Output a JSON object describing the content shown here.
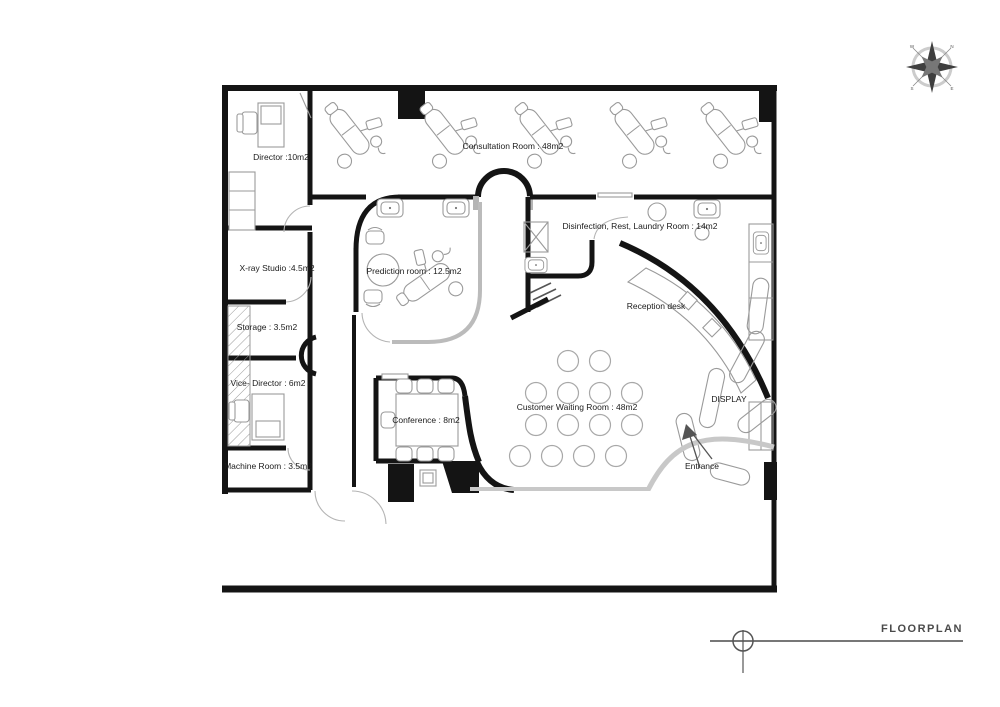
{
  "page": {
    "title": "FLOORPLAN"
  },
  "rooms": {
    "director": "Director  :10m2",
    "consultation": "Consultation Room : 48m2",
    "xray": "X-ray Studio :4.5m2",
    "storage": "Storage : 3.5m2",
    "vice_director": "Vice- Director : 6m2",
    "machine": "Machine Room : 3.5m2",
    "prediction": "Prediction room : 12.5m2",
    "disinfection": "Disinfection, Rest, Laundry Room : 14m2",
    "waiting": "Customer Waiting Room : 48m2",
    "conference": "Conference : 8m2"
  },
  "annotations": {
    "reception": "Reception desk",
    "display": "DISPLAY",
    "entrance": "Entrance"
  },
  "compass": {
    "points": [
      "N",
      "E",
      "S",
      "W"
    ]
  },
  "colors": {
    "wall": "#141414",
    "glass": "#c8c8c8",
    "furniture_line": "#9a9a9a"
  }
}
